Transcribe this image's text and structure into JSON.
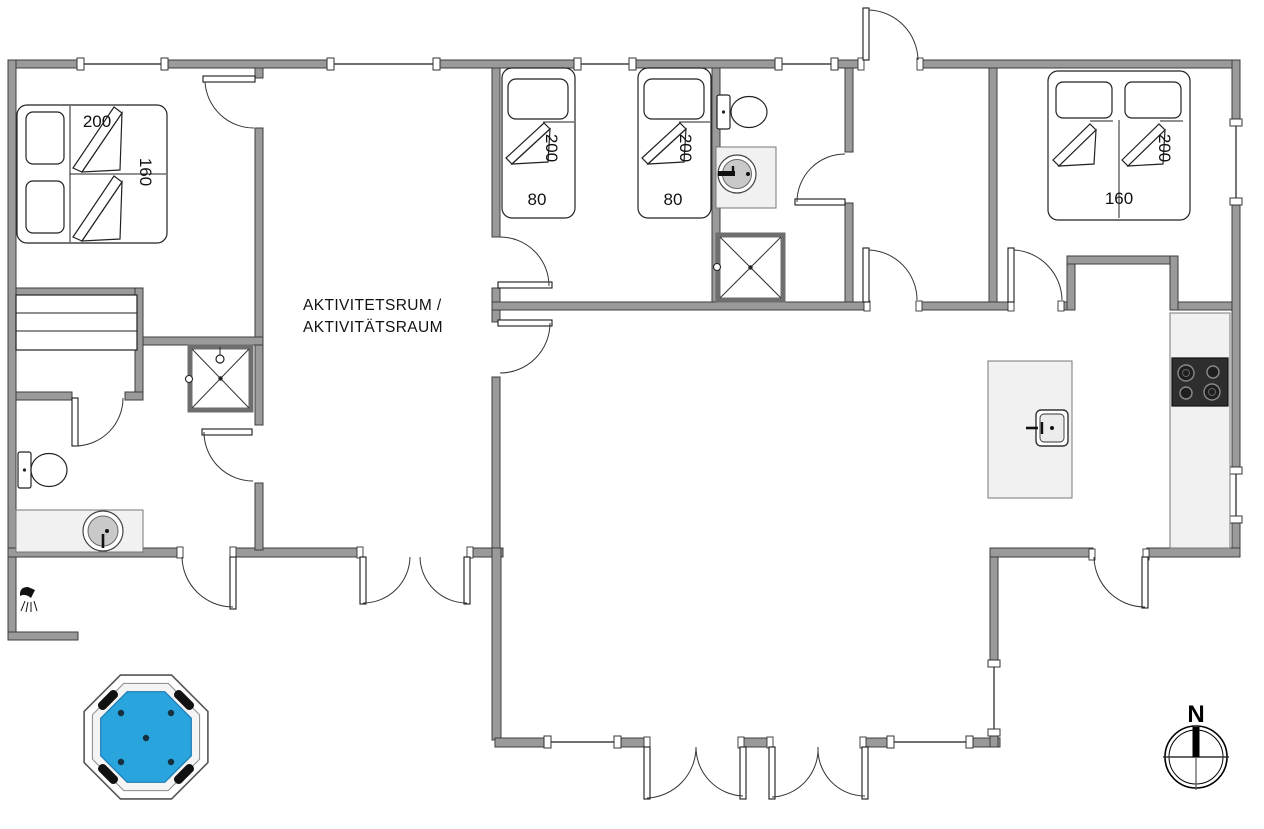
{
  "floor_plan": {
    "rooms": {
      "activity_room": {
        "label_line1": "AKTIVITETSRUM /",
        "label_line2": "AKTIVITÄTSRAUM"
      },
      "bedroom_left": {
        "bed_width_cm": "200",
        "bed_depth_cm": "160"
      },
      "kids_room": {
        "bed1": {
          "length_cm": "200",
          "width_cm": "80"
        },
        "bed2": {
          "length_cm": "200",
          "width_cm": "80"
        }
      },
      "bedroom_right": {
        "bed_length_cm": "200",
        "bed_width_cm": "160"
      }
    },
    "compass": {
      "north_label": "N"
    },
    "colors": {
      "wall_fill": "#9a9a9a",
      "wall_stroke": "#3d3d3d",
      "line": "#1a1a1a",
      "fixture_fill": "#f1f1f1",
      "basin_fill": "#c9c9c9",
      "hot_tub_water": "#29a4dc",
      "hot_tub_rim": "#555555",
      "stove_fill": "#2e2e2e",
      "background": "#ffffff"
    }
  }
}
